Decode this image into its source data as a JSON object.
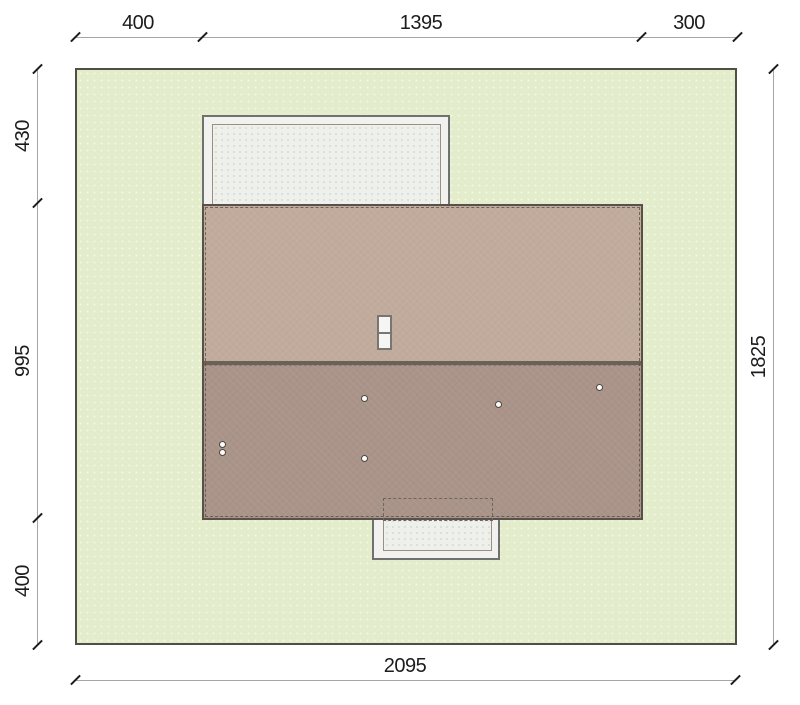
{
  "drawing": {
    "dimensions": {
      "top": [
        "400",
        "1395",
        "300"
      ],
      "left": [
        "430",
        "995",
        "400"
      ],
      "right": [
        "1825"
      ],
      "bottom": [
        "2095"
      ]
    },
    "colors": {
      "plot_fill": "#e3edcb",
      "plot_border": "#4f4f45",
      "roof_upper_slope": "#c0ab9c",
      "roof_lower_slope": "#aa9388",
      "roof_ridge": "#6b6156",
      "roof_border": "#57514a",
      "terrace_fill": "#f1f2ef",
      "terrace_border": "#707070",
      "terrace_inner_border": "#9d8f80",
      "dimension_line": "#a6a6a6",
      "dimension_text": "#1c1c1c"
    }
  }
}
